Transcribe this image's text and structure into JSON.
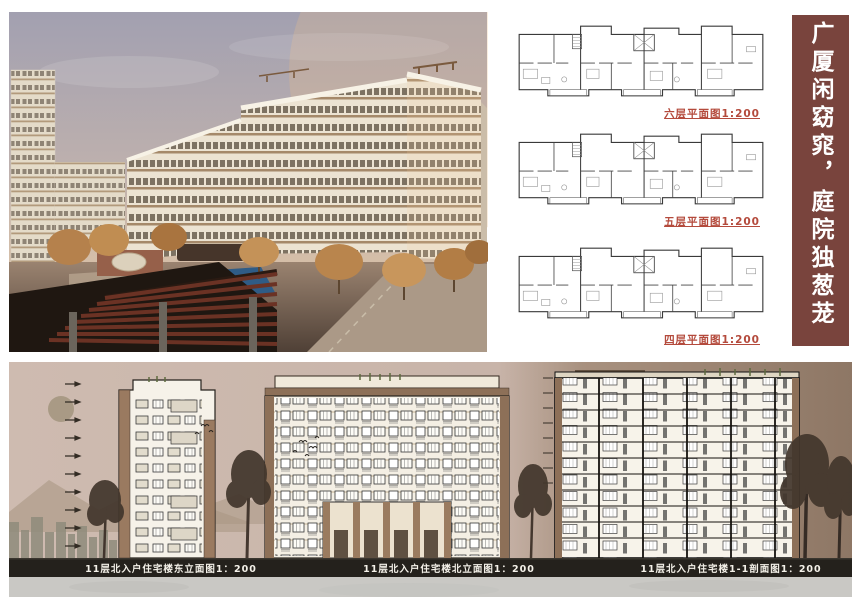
{
  "banner": {
    "text": "广厦闲窈窕，庭院独葱茏",
    "bg_color": "#79443d",
    "text_color": "#ffffff"
  },
  "plans": {
    "label_color": "#b44a3c",
    "items": [
      {
        "label": "六层平面图1:200",
        "scale": "1:200"
      },
      {
        "label": "五层平面图1:200",
        "scale": "1:200"
      },
      {
        "label": "四层平面图1:200",
        "scale": "1:200"
      }
    ]
  },
  "elevations": {
    "panel_bg": "#c9b6ab",
    "band_color": "#24211c",
    "labels": [
      {
        "text": "11层北入户住宅楼东立面图1：200",
        "scale": "1:200"
      },
      {
        "text": "11层北入户住宅楼北立面图1：200",
        "scale": "1:200"
      },
      {
        "text": "11层北入户住宅楼1-1剖面图1：200",
        "scale": "1:200"
      }
    ]
  }
}
